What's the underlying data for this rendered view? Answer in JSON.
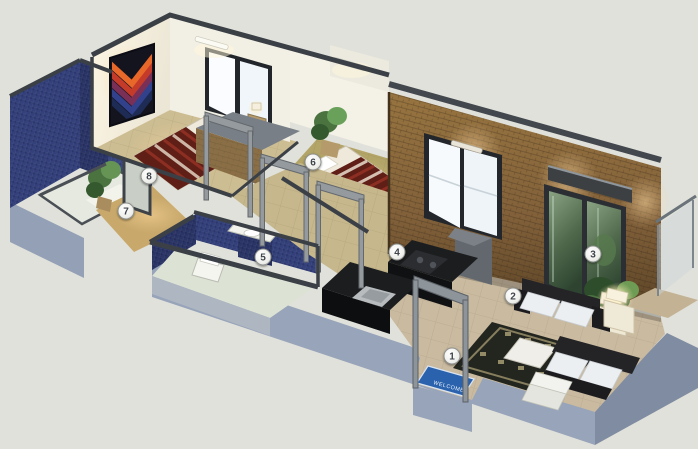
{
  "scene": {
    "doormat_text": "WELCOME",
    "markers": [
      {
        "label": "1",
        "x": 452,
        "y": 356
      },
      {
        "label": "2",
        "x": 513,
        "y": 296
      },
      {
        "label": "3",
        "x": 593,
        "y": 254
      },
      {
        "label": "4",
        "x": 397,
        "y": 252
      },
      {
        "label": "5",
        "x": 263,
        "y": 257
      },
      {
        "label": "6",
        "x": 313,
        "y": 162
      },
      {
        "label": "7",
        "x": 126,
        "y": 211
      },
      {
        "label": "8",
        "x": 149,
        "y": 176
      }
    ],
    "colors": {
      "background": "#e0e1da",
      "plinth_gray_blue": "#97a4b9",
      "floor_tile_beige": "#c9baa0",
      "bedroom_floor_olive": "#b3a568",
      "wall_white": "#f4f1e6",
      "brick_feature_wall": "#8b6a3e",
      "mosaic_tile_blue": "#33407a",
      "wall_cap_gray": "#3b4046",
      "bed_blanket_maroon": "#641f17",
      "doormat_blue": "#2a62ad",
      "warm_light_glow": "#ffd9a0",
      "plant_green": "#4a7340"
    }
  }
}
